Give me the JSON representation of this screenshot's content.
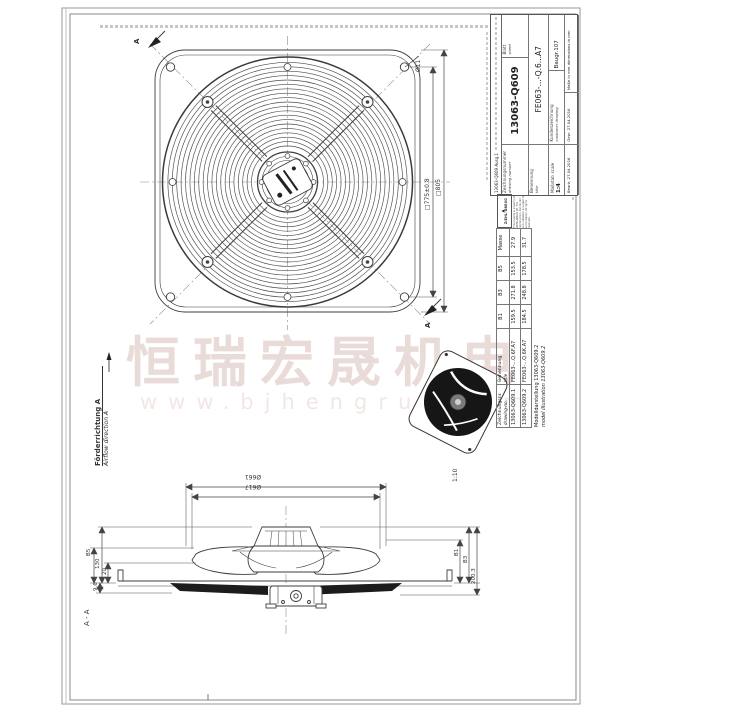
{
  "watermark": {
    "cn_text": "恒瑞宏晟机电",
    "url_text": "www.bjhengrui.com",
    "cn_color": "#e9dcd8",
    "url_color": "#f2e7e4"
  },
  "title_block": {
    "issue": "13063-Q609  Ausg.1",
    "drawing_number_label": "Zeichnungsnummer",
    "drawing_number_label_en": "drawing number",
    "drawing_number": "13063-Q609",
    "sheet_label": "Blatt",
    "sheet_label_en": "sheet",
    "title_label": "Benennung",
    "title_label_en": "title",
    "part_name": "FE063-...-Q.6...A7",
    "scale_label": "Maßstab",
    "scale_label_en": "scale",
    "scale_value": "1:4",
    "customer_drawing": "Kundenzeichnung",
    "customer_drawing_en": "customer drawing",
    "baugr": "Baugr.107",
    "drawn_label": "Bearb.",
    "drawn_date": "27.04.2016",
    "checked_label": "Gepr.",
    "checked_date": "27.04.2016",
    "dims_note": "Maße in mm",
    "dims_note_en": "dimensions in mm"
  },
  "brand_block": {
    "brand": "ZIEHL-ABEGG",
    "copyright": "This drawing is property of ZIEHL-ABEGG SE. The reproduction, distribution and utilization is subject to authorization. All rights reserved."
  },
  "parts_table": {
    "col_drawing_no": "Zeichnungsnr.",
    "col_drawing_no_en": "drawing-no.",
    "col_name": "Benennung",
    "col_name_en": "title",
    "col_b1": "B1",
    "col_b3": "B3",
    "col_b5": "B5",
    "col_mass": "Masse",
    "rows": [
      [
        "13063-Q609.1",
        "FE063-...Q.6F.A7",
        "159.5",
        "271.8",
        "153.5",
        "27.9"
      ],
      [
        "13063-Q609.2",
        "FE063-...Q.6K.A7",
        "184.5",
        "248.8",
        "178.5",
        "31.7"
      ]
    ],
    "note": "Modelldarstellung  13063-Q609.2",
    "note_en": "model illustration  13063-Q609.2"
  },
  "front_view": {
    "dim_hole": "Ø11",
    "dim_hole_square": "□775±0.8",
    "dim_outer_square": "□805",
    "section_mark_top": "A",
    "section_mark_bottom": "A",
    "airflow_de": "Förderrichtung A",
    "airflow_en": "Airflow direction A"
  },
  "side_view": {
    "dim_outer_dia": "Ø661",
    "dim_inner_dia": "Ø617",
    "dim_b1": "B1",
    "dim_b3": "B3",
    "dim_height": "200.3",
    "dim_b5": "B5",
    "dim_130": "130",
    "dim_20": "20",
    "dim_9_6": "9.6",
    "section_title": "A - A"
  },
  "iso_view": {
    "scale": "1:10"
  }
}
